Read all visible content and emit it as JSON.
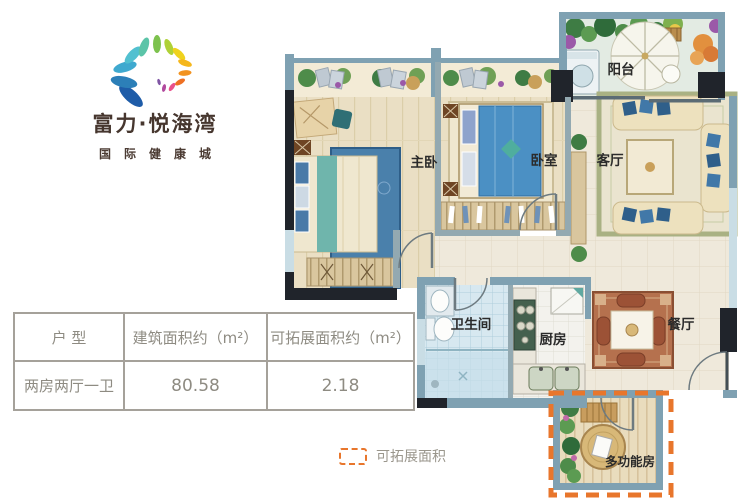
{
  "brand": {
    "name": "富力·悦海湾",
    "subtitle": "国际健康城"
  },
  "table": {
    "headers": [
      "户 型",
      "建筑面积约（m²）",
      "可拓展面积约（m²）"
    ],
    "row": [
      "两房两厅一卫",
      "80.58",
      "2.18"
    ]
  },
  "legend": {
    "label": "可拓展面积",
    "accent_color": "#e8762c"
  },
  "floorplan": {
    "unit_type": "两房两厅一卫",
    "rooms": [
      {
        "id": "master-bedroom",
        "label": "主卧"
      },
      {
        "id": "bedroom",
        "label": "卧室"
      },
      {
        "id": "living-room",
        "label": "客厅"
      },
      {
        "id": "balcony",
        "label": "阳台"
      },
      {
        "id": "bathroom",
        "label": "卫生间"
      },
      {
        "id": "kitchen",
        "label": "厨房"
      },
      {
        "id": "dining-room",
        "label": "餐厅"
      },
      {
        "id": "multi-function-room",
        "label": "多功能房"
      }
    ]
  }
}
